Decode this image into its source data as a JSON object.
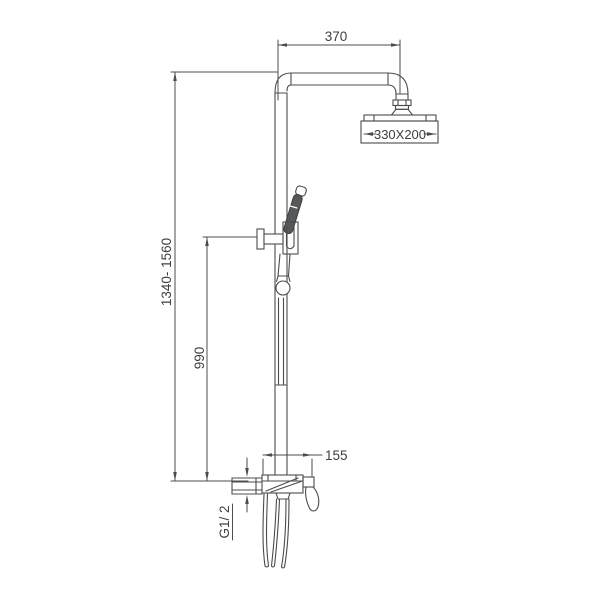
{
  "diagram": {
    "type": "technical-drawing",
    "subject": "exposed-shower-column-with-overhead-and-hand-shower",
    "colors": {
      "background": "#ffffff",
      "line": "#4c4c4c",
      "text": "#3f3f3f",
      "handle_fill": "#57585a"
    },
    "labels": {
      "arm_length": "370",
      "head_size": "330X200",
      "overall_height": "1340- 1560",
      "slide_height": "990",
      "mixer_width": "155",
      "inlet_thread": "G1/ 2"
    }
  }
}
